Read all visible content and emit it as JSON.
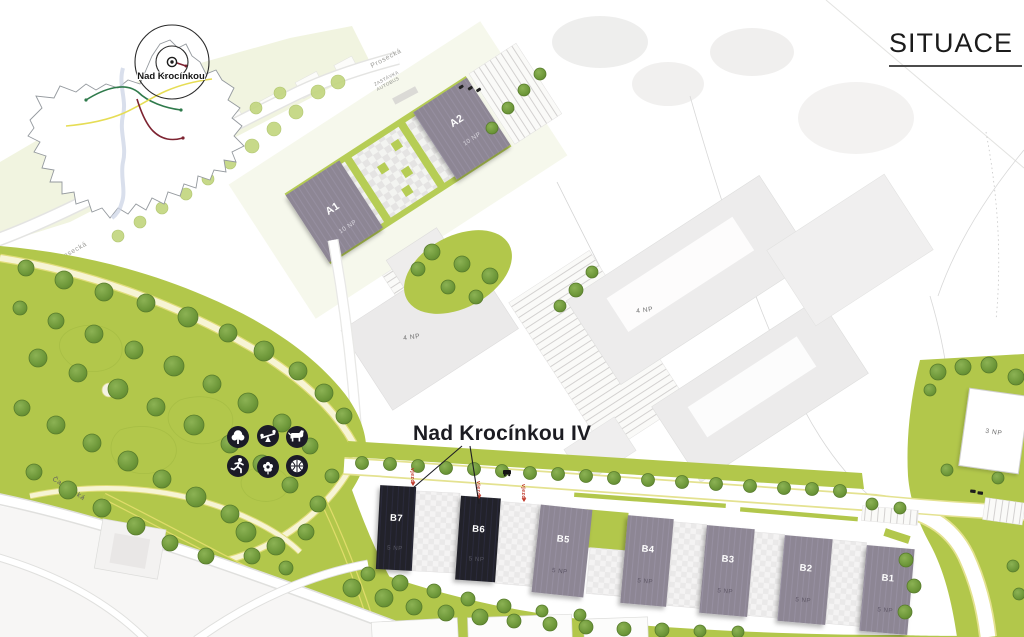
{
  "header": {
    "title": "SITUACE"
  },
  "inset_map": {
    "location_label": "Nad Krocínkou"
  },
  "plan": {
    "project_label": "Nad Krocínkou IV",
    "entrance_label": "vjezd",
    "bus_stop": {
      "line1": "ZASTÁVKA",
      "line2": "AUTOBUS"
    },
    "streets": {
      "prosecka": "Prosecká",
      "cakovicka": "Čakovická"
    },
    "buildings": {
      "a1": {
        "name": "A1",
        "floors": "10 NP"
      },
      "a2": {
        "name": "A2",
        "floors": "10 NP"
      },
      "b1": {
        "name": "B1",
        "floors": "5 NP"
      },
      "b2": {
        "name": "B2",
        "floors": "5 NP"
      },
      "b3": {
        "name": "B3",
        "floors": "5 NP"
      },
      "b4": {
        "name": "B4",
        "floors": "5 NP"
      },
      "b5": {
        "name": "B5",
        "floors": "5 NP"
      },
      "b6": {
        "name": "B6",
        "floors": "5 NP"
      },
      "b7": {
        "name": "B7",
        "floors": "5 NP"
      },
      "existing_west": {
        "floors": "4 NP"
      },
      "existing_east": {
        "floors": "4 NP"
      },
      "existing_north": {
        "floors": "3 NP"
      }
    },
    "amenities": [
      "tree-icon",
      "playground-icon",
      "dog-icon",
      "runner-icon",
      "flower-icon",
      "basketball-icon"
    ],
    "colors": {
      "park_green": "#b2c74b",
      "tree_green": "#6f9a3c",
      "building_gray": "#8b8492",
      "highlight_dark": "#1f1f2a",
      "entrance_red": "#c0392b",
      "path_yellow": "#dfdc6a"
    }
  }
}
